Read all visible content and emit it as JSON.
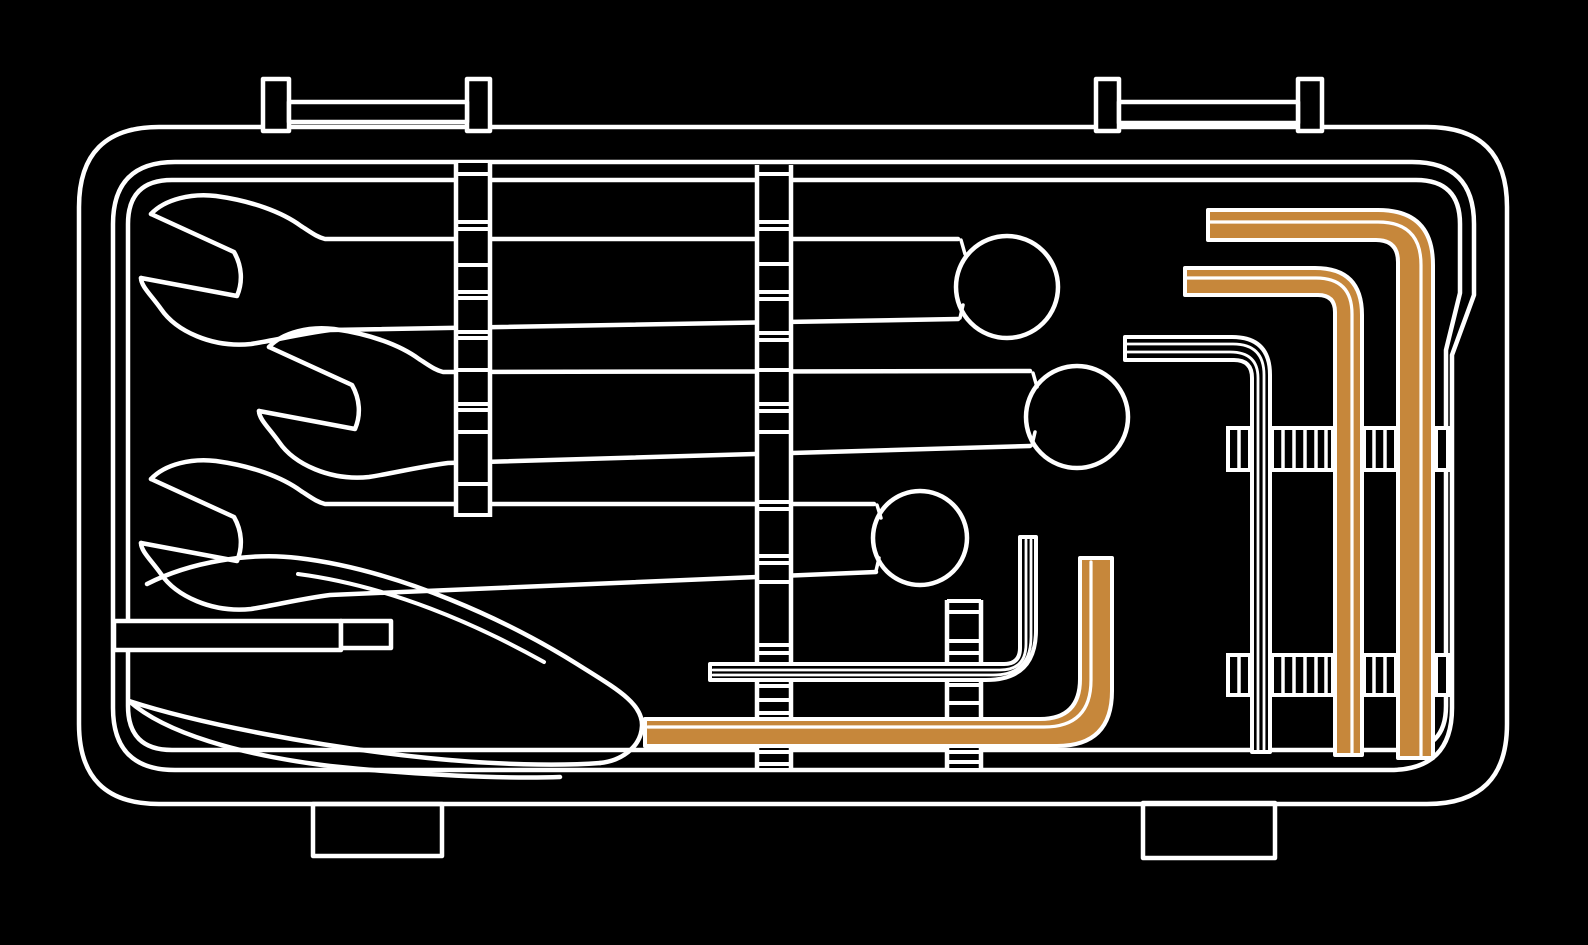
{
  "meta": {
    "canvas_width": 1588,
    "canvas_height": 945
  },
  "colors": {
    "background": "#000000",
    "line": "#ffffff",
    "accent": "#C6873B"
  },
  "depicted_objects": [
    "tool-case",
    "open-end-wrench-top",
    "open-end-wrench-middle",
    "open-end-wrench-bottom",
    "retaining-strip-left",
    "retaining-strip-middle",
    "retaining-strip-short",
    "tray-wedge",
    "hex-key-large-accent",
    "hex-key-medium-accent",
    "hex-key-white",
    "hex-key-middle-accent",
    "hex-key-middle-white",
    "clip-band-upper",
    "clip-band-lower"
  ],
  "scene": {
    "shapes": [
      {
        "name": "case-outer-shell",
        "type": "path",
        "stroke": "line",
        "w": 4.5,
        "fill": "none",
        "d": "M159,127 H1427 Q1507,127 1507,207 V724 Q1507,804 1427,804 H159 Q79,804 79,724 V207 Q79,127 159,127 Z"
      },
      {
        "name": "case-inner-shell",
        "type": "path",
        "stroke": "line",
        "w": 4.5,
        "fill": "none",
        "d": "M175,162 H1412 Q1474,162 1474,224 V295 L1452,355 V708 Q1452,770 1390,770 H175 Q113,770 113,708 V224 Q113,162 175,162 Z"
      },
      {
        "name": "tray-outline",
        "type": "path",
        "stroke": "line",
        "w": 4.5,
        "fill": "none",
        "d": "M172,180 H1416 Q1460,180 1460,224 V293 L1446,350 V706 Q1446,750 1402,750 H172 Q128,750 128,706 V224 Q128,180 172,180 Z"
      },
      {
        "name": "latch-left-post-a",
        "type": "rect",
        "x": 263,
        "y": 79,
        "w2": 26,
        "h": 52,
        "stroke": "line",
        "w": 4.5,
        "fill": "background"
      },
      {
        "name": "latch-left-post-b",
        "type": "rect",
        "x": 467,
        "y": 79,
        "w2": 23,
        "h": 52,
        "stroke": "line",
        "w": 4.5,
        "fill": "background"
      },
      {
        "name": "latch-left-crossbar",
        "type": "rect",
        "x": 289,
        "y": 102,
        "w2": 178,
        "h": 20,
        "stroke": "line",
        "w": 4.5,
        "fill": "background"
      },
      {
        "name": "latch-right-post-a",
        "type": "rect",
        "x": 1096,
        "y": 79,
        "w2": 23,
        "h": 52,
        "stroke": "line",
        "w": 4.5,
        "fill": "background"
      },
      {
        "name": "latch-right-post-b",
        "type": "rect",
        "x": 1298,
        "y": 79,
        "w2": 24,
        "h": 52,
        "stroke": "line",
        "w": 4.5,
        "fill": "background"
      },
      {
        "name": "latch-right-crossbar",
        "type": "rect",
        "x": 1119,
        "y": 102,
        "w2": 179,
        "h": 21,
        "stroke": "line",
        "w": 4.5,
        "fill": "background"
      },
      {
        "name": "case-foot-left",
        "type": "rect",
        "x": 313,
        "y": 804,
        "w2": 129,
        "h": 52,
        "stroke": "line",
        "w": 4.5,
        "fill": "none"
      },
      {
        "name": "case-foot-right",
        "type": "rect",
        "x": 1143,
        "y": 803,
        "w2": 132,
        "h": 55,
        "stroke": "line",
        "w": 4.5,
        "fill": "none"
      },
      {
        "name": "tray-wedge-top-edge",
        "type": "path",
        "stroke": "line",
        "w": 4.5,
        "fill": "none",
        "d": "M147,584 C190,562 250,552 298,558 C400,570 510,622 577,664 C615,688 643,703 642,726 C641,748 620,761 600,763"
      },
      {
        "name": "tray-wedge-inner-edge",
        "type": "path",
        "stroke": "line",
        "w": 4,
        "fill": "none",
        "d": "M298,574 C390,586 478,625 544,662"
      },
      {
        "name": "tray-crescent-upper-edge",
        "type": "path",
        "stroke": "line",
        "w": 4.5,
        "fill": "none",
        "d": "M129,701 C200,724 320,747 428,758 C495,765 560,766 600,763"
      },
      {
        "name": "tray-crescent-lower-edge",
        "type": "path",
        "stroke": "line",
        "w": 4.5,
        "fill": "none",
        "d": "M129,701 C165,733 240,755 330,766 C415,775 505,779 560,777"
      },
      {
        "name": "tray-rib-bar",
        "type": "rect",
        "x": 114,
        "y": 621,
        "w2": 227,
        "h": 29,
        "stroke": "line",
        "w": 4.5,
        "fill": "background"
      },
      {
        "name": "tray-rib-bar-end",
        "type": "rect",
        "x": 341,
        "y": 621,
        "w2": 50,
        "h": 27,
        "stroke": "line",
        "w": 4.5,
        "fill": "background"
      },
      {
        "name": "wrench-top-upper-outline",
        "type": "path",
        "stroke": "line",
        "w": 4.5,
        "fill": "none",
        "d": "M151,214 C165,199 192,193 216,196 C252,201 282,212 301,226 C312,233 317,237 325,239 L958,239"
      },
      {
        "name": "wrench-top-lower-outline",
        "type": "path",
        "stroke": "line",
        "w": 4.5,
        "fill": "none",
        "d": "M958,319 L330,330 C300,334 276,340 251,344 C212,348 176,331 161,309 C151,295 141,286 141,278"
      },
      {
        "name": "wrench-top-jaw",
        "type": "path",
        "stroke": "line",
        "w": 4.5,
        "fill": "none",
        "d": "M141,278 L237,296 C243,282 242,266 234,252 L151,214"
      },
      {
        "name": "wrench-top-ring",
        "type": "circle",
        "cx": 1007,
        "cy": 287,
        "r": 51,
        "stroke": "line",
        "w": 4.5,
        "fill": "none"
      },
      {
        "name": "wrench-top-ring-tick-a",
        "type": "path",
        "stroke": "line",
        "w": 3.5,
        "fill": "none",
        "d": "M961,240 L965,254"
      },
      {
        "name": "wrench-top-ring-tick-b",
        "type": "path",
        "stroke": "line",
        "w": 3.5,
        "fill": "none",
        "d": "M960,318 L963,305"
      },
      {
        "name": "wrench-middle-upper-outline",
        "type": "path",
        "stroke": "line",
        "w": 4.5,
        "fill": "none",
        "d": "M269,347 C283,332 310,326 334,329 C370,334 400,345 419,359 C430,366 435,370 443,372 L1030,371"
      },
      {
        "name": "wrench-middle-lower-outline",
        "type": "path",
        "stroke": "line",
        "w": 4.5,
        "fill": "none",
        "d": "M1030,446 L448,463 C418,467 394,473 369,477 C330,481 294,464 279,442 C269,428 259,419 259,411"
      },
      {
        "name": "wrench-middle-jaw",
        "type": "path",
        "stroke": "line",
        "w": 4.5,
        "fill": "none",
        "d": "M259,411 L355,429 C361,415 360,399 352,385 L269,347"
      },
      {
        "name": "wrench-middle-ring",
        "type": "circle",
        "cx": 1077,
        "cy": 417,
        "r": 51,
        "stroke": "line",
        "w": 4.5,
        "fill": "none"
      },
      {
        "name": "wrench-middle-ring-tick-a",
        "type": "path",
        "stroke": "line",
        "w": 3.5,
        "fill": "none",
        "d": "M1033,373 L1037,387"
      },
      {
        "name": "wrench-middle-ring-tick-b",
        "type": "path",
        "stroke": "line",
        "w": 3.5,
        "fill": "none",
        "d": "M1032,445 L1035,432"
      },
      {
        "name": "wrench-bottom-upper-outline",
        "type": "path",
        "stroke": "line",
        "w": 4.5,
        "fill": "none",
        "d": "M151,479 C165,464 192,458 216,461 C252,466 282,477 301,491 C312,498 317,502 325,504 L874,504"
      },
      {
        "name": "wrench-bottom-lower-outline",
        "type": "path",
        "stroke": "line",
        "w": 4.5,
        "fill": "none",
        "d": "M876,572 L330,595 C300,599 276,605 251,609 C212,613 176,596 161,574 C151,560 141,551 141,543"
      },
      {
        "name": "wrench-bottom-jaw",
        "type": "path",
        "stroke": "line",
        "w": 4.5,
        "fill": "none",
        "d": "M141,543 L237,561 C243,547 242,531 234,517 L151,479"
      },
      {
        "name": "wrench-bottom-ring",
        "type": "circle",
        "cx": 920,
        "cy": 538,
        "r": 47,
        "stroke": "line",
        "w": 4.5,
        "fill": "none"
      },
      {
        "name": "wrench-bottom-ring-tick-a",
        "type": "path",
        "stroke": "line",
        "w": 3.5,
        "fill": "none",
        "d": "M877,505 L881,518"
      },
      {
        "name": "wrench-bottom-ring-tick-b",
        "type": "path",
        "stroke": "line",
        "w": 3.5,
        "fill": "none",
        "d": "M876,571 L879,558"
      },
      {
        "name": "retaining-strip-left",
        "type": "ladder",
        "x1": 454,
        "y1": 163,
        "x2": 492,
        "y2": 517,
        "rungs": [
          174,
          222,
          229,
          265,
          292,
          298,
          332,
          338,
          370,
          404,
          410,
          432,
          484,
          515
        ]
      },
      {
        "name": "retaining-strip-middle",
        "type": "ladder",
        "x1": 755,
        "y1": 165,
        "x2": 793,
        "y2": 768,
        "rungs": [
          174,
          222,
          229,
          264,
          292,
          299,
          333,
          340,
          370,
          404,
          411,
          432,
          502,
          509,
          556,
          563,
          582,
          645,
          653,
          686,
          700,
          713,
          752,
          764
        ]
      },
      {
        "name": "retaining-strip-short",
        "type": "ladder",
        "x1": 945,
        "y1": 600,
        "x2": 983,
        "y2": 768,
        "rungs": [
          601,
          612,
          641,
          653,
          685,
          703,
          752,
          762
        ]
      },
      {
        "name": "clip-band-upper",
        "type": "clipband",
        "y1": 428,
        "y2": 470,
        "boxes": [
          {
            "x1": 1228,
            "x2": 1250,
            "ribs": [
              1239
            ]
          },
          {
            "x1": 1272,
            "x2": 1333,
            "ribs": [
              1283,
              1294,
              1305,
              1316,
              1326
            ]
          },
          {
            "x1": 1364,
            "x2": 1396,
            "ribs": [
              1374,
              1385
            ]
          },
          {
            "x1": 1436,
            "x2": 1448,
            "ribs": []
          }
        ]
      },
      {
        "name": "clip-band-lower",
        "type": "clipband",
        "y1": 655,
        "y2": 695,
        "boxes": [
          {
            "x1": 1228,
            "x2": 1250,
            "ribs": [
              1239
            ]
          },
          {
            "x1": 1272,
            "x2": 1333,
            "ribs": [
              1283,
              1294,
              1305,
              1316,
              1326
            ]
          },
          {
            "x1": 1364,
            "x2": 1396,
            "ribs": [
              1374,
              1385
            ]
          },
          {
            "x1": 1436,
            "x2": 1448,
            "ribs": []
          }
        ]
      },
      {
        "name": "hex-key-middle-white-body",
        "type": "path",
        "stroke": "line",
        "w": 4,
        "fill": "background",
        "d": "M1020,537 L1036,537 L1036,630 Q1036,680 986,680 L710,680 L710,664 L1004,664 Q1020,664 1020,648 Z"
      },
      {
        "name": "hex-key-middle-white-line-a",
        "type": "path",
        "stroke": "line",
        "w": 2.8,
        "fill": "none",
        "d": "M1026,540 L1026,644 Q1026,670 1000,670 L713,670"
      },
      {
        "name": "hex-key-middle-white-line-b",
        "type": "path",
        "stroke": "line",
        "w": 2.8,
        "fill": "none",
        "d": "M1031,540 L1031,637 Q1031,675 993,675 L713,675"
      },
      {
        "name": "hex-key-middle-accent-body",
        "type": "path",
        "stroke": "line",
        "w": 4,
        "fill": "accent",
        "d": "M1080,558 L1112,558 L1112,691 Q1112,746 1057,746 L645,746 L645,719 L1040,719 Q1080,719 1080,679 Z"
      },
      {
        "name": "hex-key-middle-accent-stripe",
        "type": "path",
        "stroke": "line",
        "w": 3.2,
        "fill": "none",
        "d": "M1091,562 L1091,680 Q1091,727 1044,727 L648,727"
      },
      {
        "name": "hex-key-white-body",
        "type": "path",
        "stroke": "line",
        "w": 4,
        "fill": "background",
        "d": "M1125,337 L1232,337 Q1270,337 1270,375 L1270,752 L1252,752 L1252,378 Q1252,360 1234,360 L1125,360 Z"
      },
      {
        "name": "hex-key-white-line-a",
        "type": "path",
        "stroke": "line",
        "w": 2.8,
        "fill": "none",
        "d": "M1127,344 L1233,344 Q1264,344 1264,375 L1264,750"
      },
      {
        "name": "hex-key-white-line-b",
        "type": "path",
        "stroke": "line",
        "w": 2.8,
        "fill": "none",
        "d": "M1127,352 L1230,352 Q1258,352 1258,378 L1258,750"
      },
      {
        "name": "hex-key-medium-accent-body",
        "type": "path",
        "stroke": "line",
        "w": 4,
        "fill": "accent",
        "d": "M1185,268 L1315,268 Q1362,268 1362,315 L1362,755 L1335,755 L1335,312 Q1335,295 1318,295 L1185,295 Z"
      },
      {
        "name": "hex-key-medium-accent-stripe",
        "type": "path",
        "stroke": "line",
        "w": 3.2,
        "fill": "none",
        "d": "M1187,278 L1316,278 Q1352,278 1352,314 L1352,753"
      },
      {
        "name": "hex-key-large-accent-body",
        "type": "path",
        "stroke": "line",
        "w": 4,
        "fill": "accent",
        "d": "M1208,210 L1378,210 Q1433,210 1433,265 L1433,758 L1398,758 L1398,262 Q1398,240 1376,240 L1208,240 Z"
      },
      {
        "name": "hex-key-large-accent-stripe",
        "type": "path",
        "stroke": "line",
        "w": 3.2,
        "fill": "none",
        "d": "M1210,222 L1378,222 Q1421,222 1421,265 L1421,756"
      }
    ]
  }
}
